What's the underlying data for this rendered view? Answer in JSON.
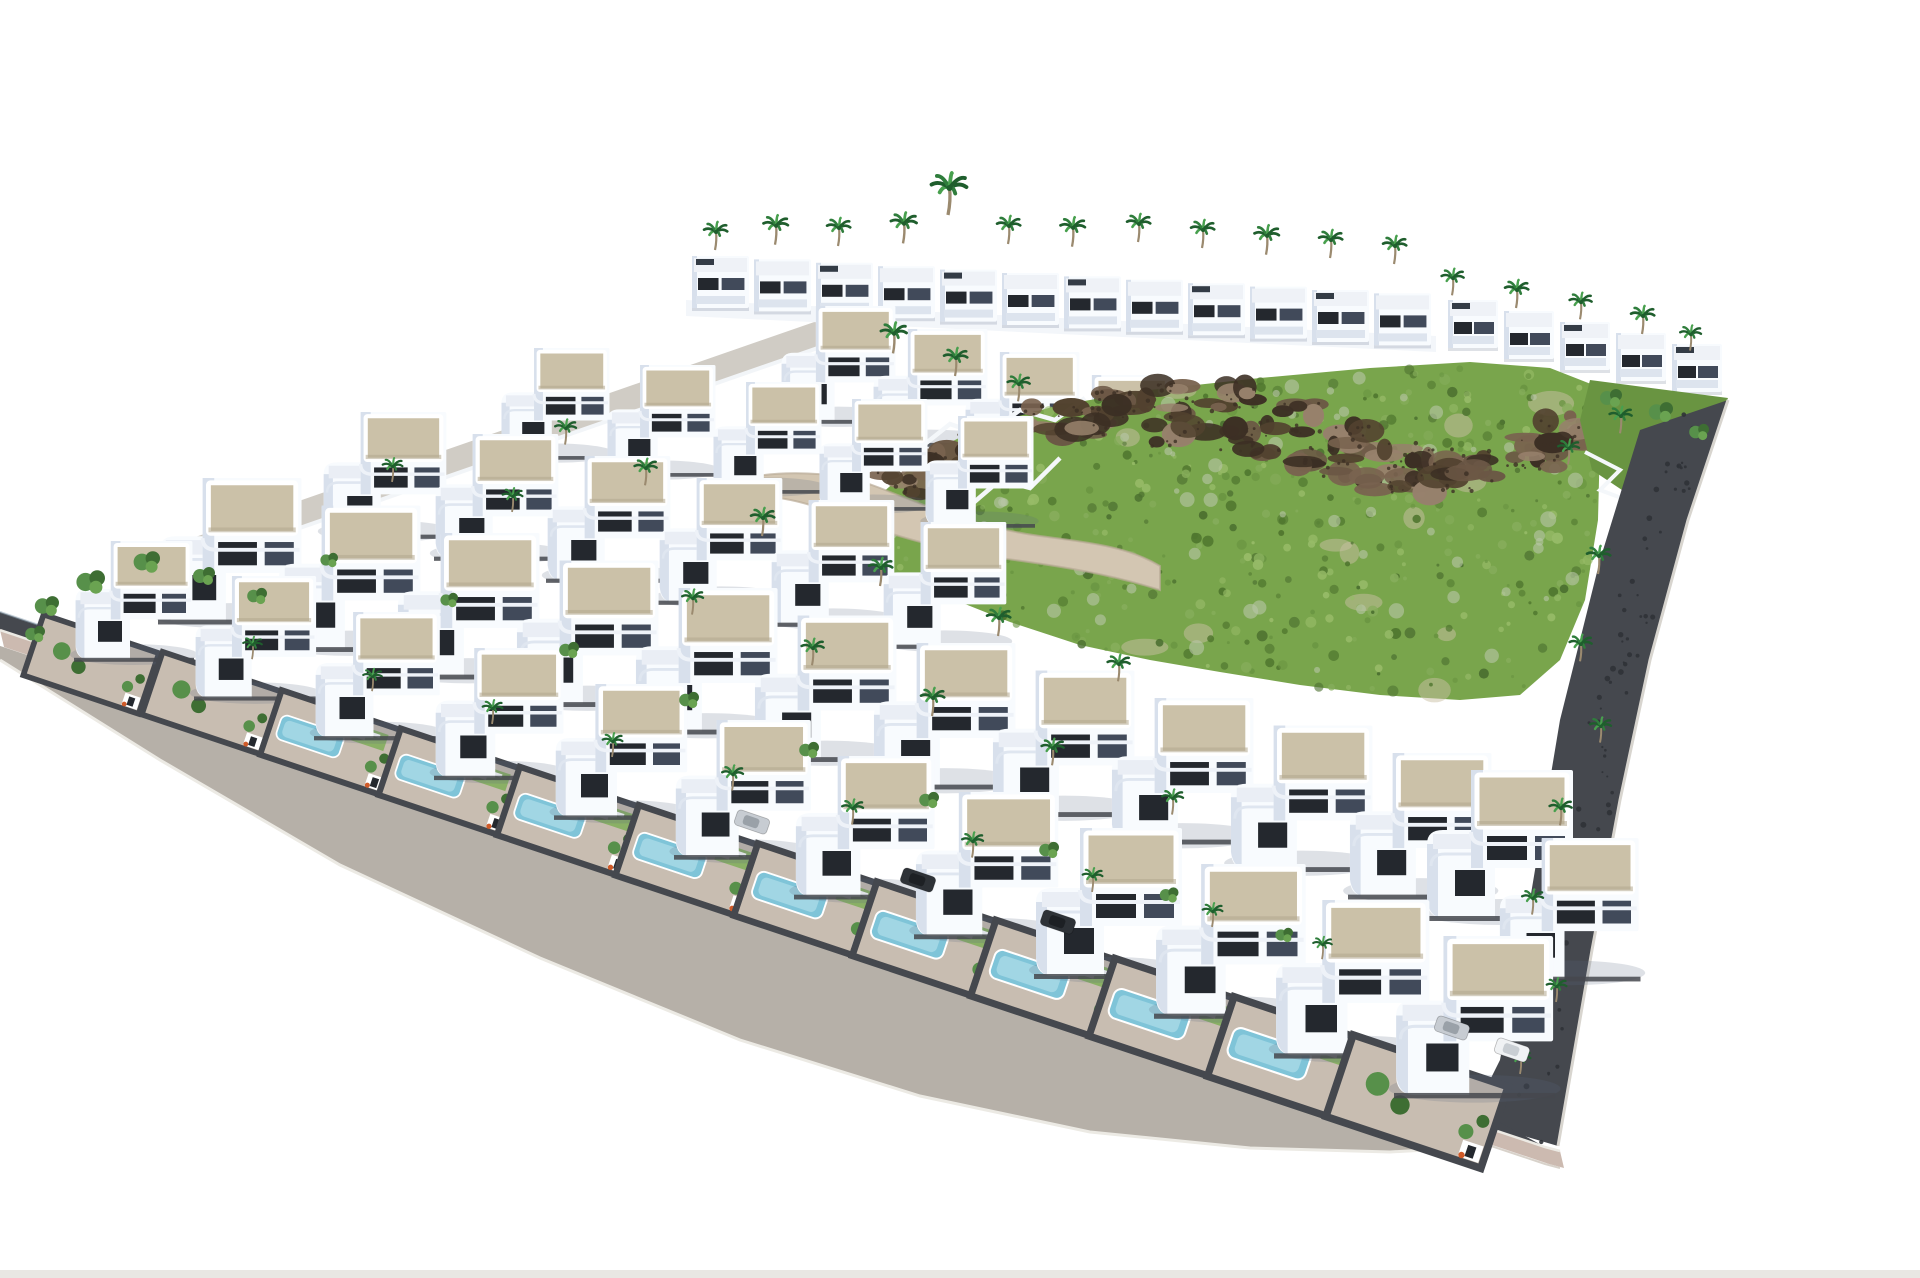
{
  "meta": {
    "title": "Aerial 3D render of a hillside villa development with pools, palm trees and access road",
    "kind": "architectural-visualization"
  },
  "palette": {
    "bg": "#ffffff",
    "villa_white": "#f8fbfe",
    "villa_shade": "#d8e0ec",
    "villa_shade2": "#c2cdde",
    "roof_tan": "#cbc1a8",
    "roof_tan_dark": "#b2a88e",
    "roof_white": "#eff2f7",
    "window_dark": "#24282e",
    "window_mid": "#414a5a",
    "wall_dark": "#45484e",
    "wall_darker": "#2f3237",
    "road_gray": "#b6b0a8",
    "sidewalk_pink": "#ccbab0",
    "curb_white": "#eceae4",
    "curb_dark": "#d8d2ca",
    "street_gray": "#d0ccc5",
    "inner_road": "#d3c6b2",
    "paving": "#c8bdb1",
    "pool_blue": "#7fc4d8",
    "pool_light": "#bde5ef",
    "grass_base": "#79a54c",
    "grass_dark": "#50772f",
    "grass_mid": "#699441",
    "grass_light": "#97bb68",
    "sage": "#b9c7a8",
    "sand_patch": "#c9c0a4",
    "rock_mid": "#79634f",
    "rock_dark": "#52422f",
    "rock_deep": "#3c2f24",
    "rock_light": "#97816c",
    "palm_green": "#2f7d3c",
    "palm_dark": "#1f5e2d",
    "palm_light": "#48a04e",
    "trunk": "#9b8a6f",
    "tree_green": "#57904a",
    "tree_dark": "#3e6e33",
    "car_dark": "#2e3237",
    "car_silver": "#c7ccd2",
    "car_white": "#f0f2f4",
    "planter_flower": "#cf5a28",
    "shadow": "rgba(90,105,130,0.20)",
    "bottom_strip": "#e9e7e3"
  },
  "scene": {
    "canvas": {
      "w": 1920,
      "h": 1278
    },
    "road_line": {
      "x0": 0,
      "y0": 630,
      "slope": 0.3346
    },
    "asphalt_outer": [
      [
        0,
        660
      ],
      [
        160,
        760
      ],
      [
        340,
        865
      ],
      [
        540,
        958
      ],
      [
        740,
        1040
      ],
      [
        920,
        1096
      ],
      [
        1090,
        1132
      ],
      [
        1250,
        1148
      ],
      [
        1390,
        1152
      ],
      [
        1462,
        1148
      ]
    ],
    "asphalt_inner": [
      [
        1462,
        1135
      ],
      [
        1240,
        1061
      ],
      [
        1000,
        981
      ],
      [
        760,
        900
      ],
      [
        520,
        820
      ],
      [
        300,
        746
      ],
      [
        120,
        686
      ],
      [
        0,
        646
      ]
    ],
    "sidewalk_top": [
      [
        0,
        630
      ],
      [
        400,
        764
      ],
      [
        800,
        898
      ],
      [
        1200,
        1032
      ],
      [
        1545,
        1147
      ],
      [
        1560,
        1151
      ]
    ],
    "wall_band_top": [
      [
        0,
        612
      ],
      [
        400,
        746
      ],
      [
        800,
        880
      ],
      [
        1200,
        1014
      ],
      [
        1470,
        1106
      ]
    ],
    "upper_street": {
      "from": [
        150,
        566
      ],
      "to": [
        858,
        320
      ],
      "width": 25
    },
    "back_terrace": [
      [
        686,
        300
      ],
      [
        1436,
        336
      ],
      [
        1436,
        352
      ],
      [
        686,
        316
      ]
    ],
    "back_row": {
      "x": 692,
      "y": 256,
      "dx": 62,
      "dy": 3.4,
      "count": 12,
      "w": 57,
      "h": 52
    },
    "right_wing": {
      "x": 1448,
      "y": 300,
      "dx": 56,
      "dy": 11,
      "count": 5,
      "w": 50,
      "h": 48
    },
    "upper_villas": {
      "x": 780,
      "y": 306,
      "dx": 92,
      "dy": 23,
      "count": 4,
      "s": 0.78
    },
    "villa_rows": [
      {
        "x": 500,
        "y": 348,
        "dx": 106,
        "dy": 17,
        "count": 5,
        "s": 0.74
      },
      {
        "x": 322,
        "y": 412,
        "dx": 112,
        "dy": 22,
        "count": 6,
        "s": 0.84
      },
      {
        "x": 158,
        "y": 478,
        "dx": 119,
        "dy": 27.5,
        "count": 11,
        "s": 0.97
      }
    ],
    "extra_villas": [
      [
        1425,
        770,
        1.0
      ],
      [
        1498,
        838,
        0.95
      ]
    ],
    "front_row": [
      {
        "x": 74,
        "y": 541,
        "s": 0.8,
        "pool": false
      },
      {
        "x": 194,
        "y": 576,
        "s": 0.825,
        "pool": false
      },
      {
        "x": 314,
        "y": 612,
        "s": 0.85,
        "pool": true
      },
      {
        "x": 434,
        "y": 648,
        "s": 0.875,
        "pool": true
      },
      {
        "x": 554,
        "y": 684,
        "s": 0.9,
        "pool": true
      },
      {
        "x": 674,
        "y": 720,
        "s": 0.925,
        "pool": true
      },
      {
        "x": 794,
        "y": 756,
        "s": 0.95,
        "pool": true
      },
      {
        "x": 914,
        "y": 792,
        "s": 0.975,
        "pool": true
      },
      {
        "x": 1034,
        "y": 828,
        "s": 1.0,
        "pool": true
      },
      {
        "x": 1154,
        "y": 864,
        "s": 1.025,
        "pool": true
      },
      {
        "x": 1274,
        "y": 900,
        "s": 1.05,
        "pool": true
      },
      {
        "x": 1394,
        "y": 936,
        "s": 1.075,
        "pool": false
      }
    ],
    "hill": [
      [
        848,
        548
      ],
      [
        880,
        495
      ],
      [
        925,
        455
      ],
      [
        985,
        425
      ],
      [
        1060,
        405
      ],
      [
        1150,
        390
      ],
      [
        1260,
        378
      ],
      [
        1370,
        368
      ],
      [
        1470,
        362
      ],
      [
        1550,
        368
      ],
      [
        1596,
        386
      ],
      [
        1600,
        440
      ],
      [
        1598,
        520
      ],
      [
        1585,
        600
      ],
      [
        1560,
        660
      ],
      [
        1520,
        695
      ],
      [
        1460,
        700
      ],
      [
        1380,
        695
      ],
      [
        1300,
        685
      ],
      [
        1220,
        672
      ],
      [
        1150,
        660
      ],
      [
        1080,
        645
      ],
      [
        1010,
        622
      ],
      [
        950,
        598
      ],
      [
        905,
        578
      ],
      [
        870,
        562
      ]
    ],
    "rock_anchors": [
      [
        870,
        520
      ],
      [
        900,
        488
      ],
      [
        940,
        462
      ],
      [
        990,
        440
      ],
      [
        1050,
        422
      ],
      [
        1110,
        408
      ],
      [
        1170,
        400
      ],
      [
        1230,
        396
      ],
      [
        1290,
        418
      ],
      [
        1350,
        440
      ],
      [
        1410,
        458
      ],
      [
        1470,
        466
      ],
      [
        1530,
        452
      ],
      [
        1570,
        430
      ],
      [
        1250,
        440
      ],
      [
        1320,
        462
      ],
      [
        1390,
        476
      ],
      [
        1450,
        480
      ],
      [
        1180,
        430
      ],
      [
        1100,
        420
      ]
    ],
    "retaining_walls": [
      [
        [
          850,
          470
        ],
        [
          880,
          440
        ],
        [
          915,
          452
        ],
        [
          950,
          424
        ],
        [
          985,
          436
        ],
        [
          1020,
          410
        ],
        [
          1055,
          420
        ],
        [
          1085,
          398
        ]
      ],
      [
        [
          838,
          548
        ],
        [
          870,
          520
        ],
        [
          900,
          530
        ],
        [
          935,
          500
        ],
        [
          965,
          510
        ],
        [
          1000,
          480
        ],
        [
          1030,
          488
        ],
        [
          1060,
          458
        ]
      ]
    ],
    "inner_road": "M 700,490 C 760,468 830,468 880,488 C 930,508 980,528 1040,536 C 1100,544 1130,548 1160,566 L 1160,590 C 1110,574 1060,566 1000,558 C 940,550 880,532 830,512 C 780,492 735,492 700,505 Z",
    "right_strip_outer": [
      [
        1728,
        400
      ],
      [
        1688,
        520
      ],
      [
        1650,
        660
      ],
      [
        1620,
        800
      ],
      [
        1592,
        950
      ],
      [
        1558,
        1146
      ]
    ],
    "right_strip_inner": [
      [
        1640,
        430
      ],
      [
        1600,
        560
      ],
      [
        1560,
        720
      ],
      [
        1530,
        900
      ],
      [
        1500,
        1060
      ],
      [
        1470,
        1120
      ]
    ],
    "hill_right_garden": [
      [
        1590,
        380
      ],
      [
        1728,
        398
      ],
      [
        1700,
        462
      ],
      [
        1640,
        502
      ],
      [
        1592,
        470
      ],
      [
        1580,
        420
      ]
    ],
    "hill_stairs": [
      [
        1585,
        452
      ],
      [
        1620,
        470
      ],
      [
        1600,
        490
      ],
      [
        1640,
        505
      ],
      [
        1618,
        525
      ],
      [
        1655,
        540
      ]
    ],
    "palms": [
      [
        715,
        236,
        1
      ],
      [
        775,
        230,
        1.05
      ],
      [
        838,
        232,
        1
      ],
      [
        903,
        228,
        1.1
      ],
      [
        948,
        194,
        1.5
      ],
      [
        1008,
        230,
        1
      ],
      [
        1072,
        232,
        1.05
      ],
      [
        1138,
        228,
        1
      ],
      [
        1202,
        234,
        1
      ],
      [
        1266,
        240,
        1.05
      ],
      [
        1330,
        244,
        1
      ],
      [
        1394,
        250,
        1
      ],
      [
        1452,
        282,
        0.95
      ],
      [
        1516,
        294,
        1
      ],
      [
        1580,
        306,
        0.95
      ],
      [
        1642,
        320,
        1
      ],
      [
        1690,
        338,
        0.9
      ],
      [
        893,
        338,
        1.1
      ],
      [
        955,
        362,
        1
      ],
      [
        1018,
        388,
        0.95
      ],
      [
        565,
        432,
        0.9
      ],
      [
        645,
        472,
        0.95
      ],
      [
        762,
        522,
        1
      ],
      [
        880,
        572,
        1
      ],
      [
        998,
        622,
        1
      ],
      [
        1118,
        668,
        0.95
      ],
      [
        692,
        602,
        0.9
      ],
      [
        812,
        652,
        0.95
      ],
      [
        932,
        702,
        1
      ],
      [
        1052,
        752,
        0.95
      ],
      [
        1172,
        802,
        0.9
      ],
      [
        512,
        500,
        0.85
      ],
      [
        392,
        470,
        0.85
      ],
      [
        1568,
        452,
        0.9
      ],
      [
        1620,
        420,
        0.95
      ],
      [
        1598,
        560,
        1
      ],
      [
        1580,
        648,
        0.95
      ],
      [
        1600,
        730,
        0.9
      ],
      [
        1560,
        812,
        0.95
      ],
      [
        1532,
        902,
        0.9
      ],
      [
        1556,
        990,
        0.85
      ],
      [
        1520,
        1062,
        0.85
      ],
      [
        252,
        648,
        0.8
      ],
      [
        372,
        680,
        0.8
      ],
      [
        492,
        712,
        0.85
      ],
      [
        612,
        745,
        0.85
      ],
      [
        732,
        778,
        0.9
      ],
      [
        852,
        812,
        0.9
      ],
      [
        972,
        845,
        0.9
      ],
      [
        1092,
        880,
        0.85
      ],
      [
        1212,
        915,
        0.85
      ],
      [
        1322,
        948,
        0.8
      ]
    ],
    "trees": [
      [
        48,
        606,
        1.1
      ],
      [
        92,
        582,
        1.3
      ],
      [
        148,
        562,
        1.2
      ],
      [
        205,
        576,
        1.0
      ],
      [
        258,
        596,
        0.9
      ],
      [
        36,
        634,
        0.9
      ],
      [
        330,
        560,
        0.8
      ],
      [
        450,
        600,
        0.8
      ],
      [
        570,
        650,
        0.9
      ],
      [
        690,
        700,
        0.9
      ],
      [
        810,
        750,
        0.9
      ],
      [
        930,
        800,
        0.9
      ],
      [
        1050,
        850,
        0.9
      ],
      [
        1170,
        895,
        0.85
      ],
      [
        1285,
        935,
        0.8
      ],
      [
        1612,
        398,
        1.0
      ],
      [
        1662,
        412,
        1.1
      ],
      [
        1700,
        432,
        0.9
      ]
    ],
    "cars": [
      {
        "x": 752,
        "y": 822,
        "a": 19,
        "t": "silver"
      },
      {
        "x": 918,
        "y": 880,
        "a": 19,
        "t": "dark"
      },
      {
        "x": 1058,
        "y": 922,
        "a": 19,
        "t": "dark"
      },
      {
        "x": 1452,
        "y": 1028,
        "a": 19,
        "t": "silver"
      },
      {
        "x": 1512,
        "y": 1050,
        "a": 19,
        "t": "white"
      }
    ],
    "bottom_strip": {
      "y": 1270,
      "h": 8
    }
  }
}
